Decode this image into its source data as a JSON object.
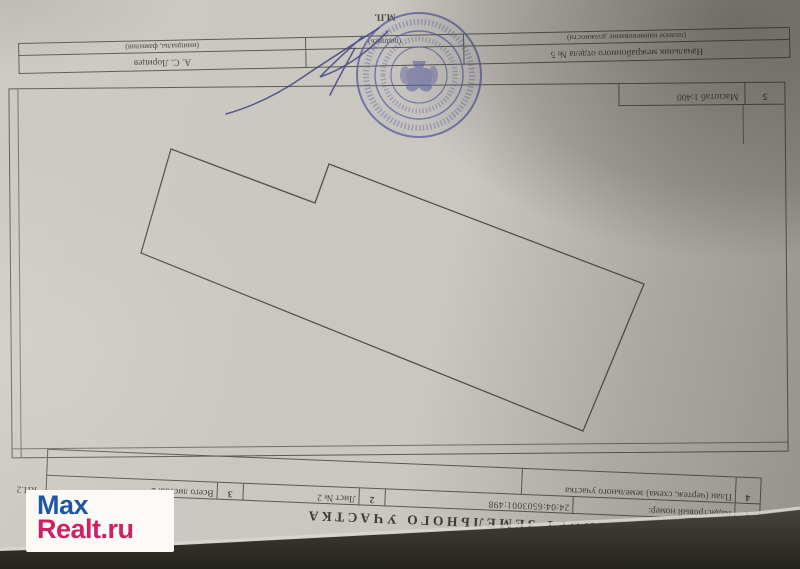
{
  "photo": {
    "watermark": {
      "line1": "Max",
      "line2": "Realt.ru"
    }
  },
  "document": {
    "issue_line": {
      "date": "«14» октября 2015 г.",
      "number": "№ 24/15-733696"
    },
    "title": "КАДАСТРОВЫЙ ПАСПОРТ ЗЕМЕЛЬНОГО УЧАСТКА",
    "form_code": "КП.2",
    "header_table": {
      "row1": {
        "num": "1",
        "label": "Кадастровый номер:",
        "value": "24:04:6503001:498"
      },
      "sheet": {
        "num": "2",
        "label": "Лист № 2"
      },
      "total": {
        "num": "3",
        "label": "Всего листов: 2"
      },
      "row4": {
        "num": "4",
        "label": "План (чертеж, схема) земельного участка"
      }
    },
    "plan": {
      "scale_num": "5",
      "scale_label": "Масштаб 1:400",
      "polygon_points": "629,420 485,366 471,405 156,285 217,138 659,316"
    },
    "signature_block": {
      "position_value": "Начальник межрайонного отдела № 5",
      "position_hint": "(полное наименование должности)",
      "signature_hint": "(подпись)",
      "name_value": "А. С. Лорицев",
      "name_hint": "(инициалы, фамилия)",
      "seal_mark": "М.П."
    }
  },
  "colors": {
    "paper": "#cac7c0",
    "ink": "#47443e",
    "stamp_blue": "#5b5fa2",
    "watermark_blue": "#1d57a5",
    "watermark_red": "#d02063",
    "desk": "#35342e"
  }
}
